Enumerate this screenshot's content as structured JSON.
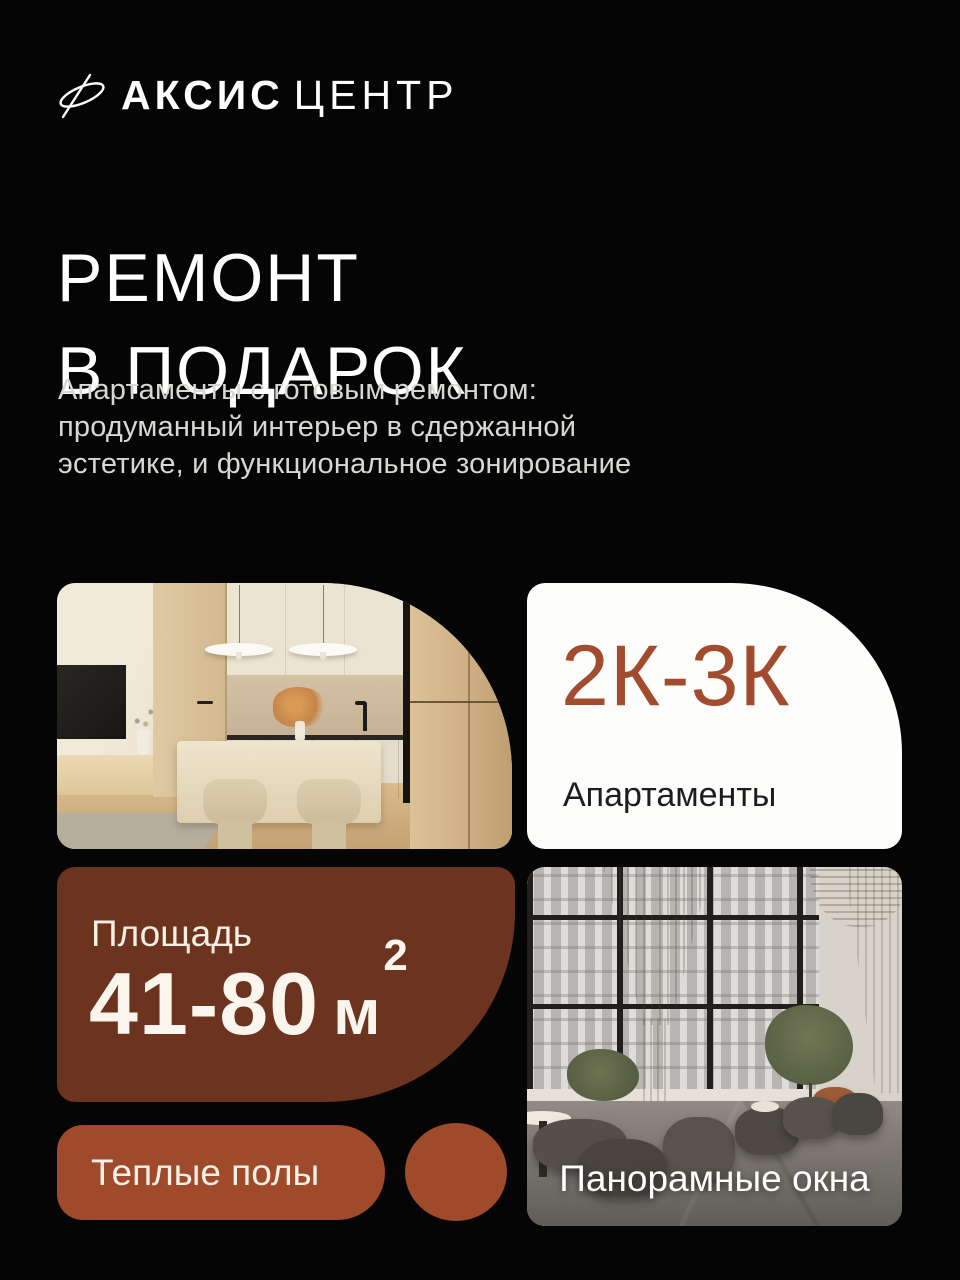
{
  "poster": {
    "background_color": "#050505",
    "brand": {
      "icon": "axis-orbit-logo",
      "name_primary": "АКСИС",
      "name_secondary": "ЦЕНТР"
    },
    "hero": {
      "title_line1": "РЕМОНТ",
      "title_line2": "В ПОДАРОК",
      "subtitle_lines": [
        "Апартаменты с готовым ремонтом:",
        "продуманный интерьер в сдержанной",
        "эстетике, и функциональное зонирование"
      ]
    },
    "cards": {
      "rooms": {
        "value": "2К-3К",
        "label": "Апартаменты",
        "text_color": "#A24B2F",
        "background_color": "#FFFFFF"
      },
      "area": {
        "label": "Площадь",
        "value": "41-80",
        "unit": "м",
        "unit_superscript": "2",
        "background_color": "#6C341E"
      },
      "features": [
        {
          "label": "Теплые полы",
          "background_color": "#9E4A2B"
        }
      ],
      "panorama": {
        "label": "Панорамные окна"
      }
    }
  }
}
